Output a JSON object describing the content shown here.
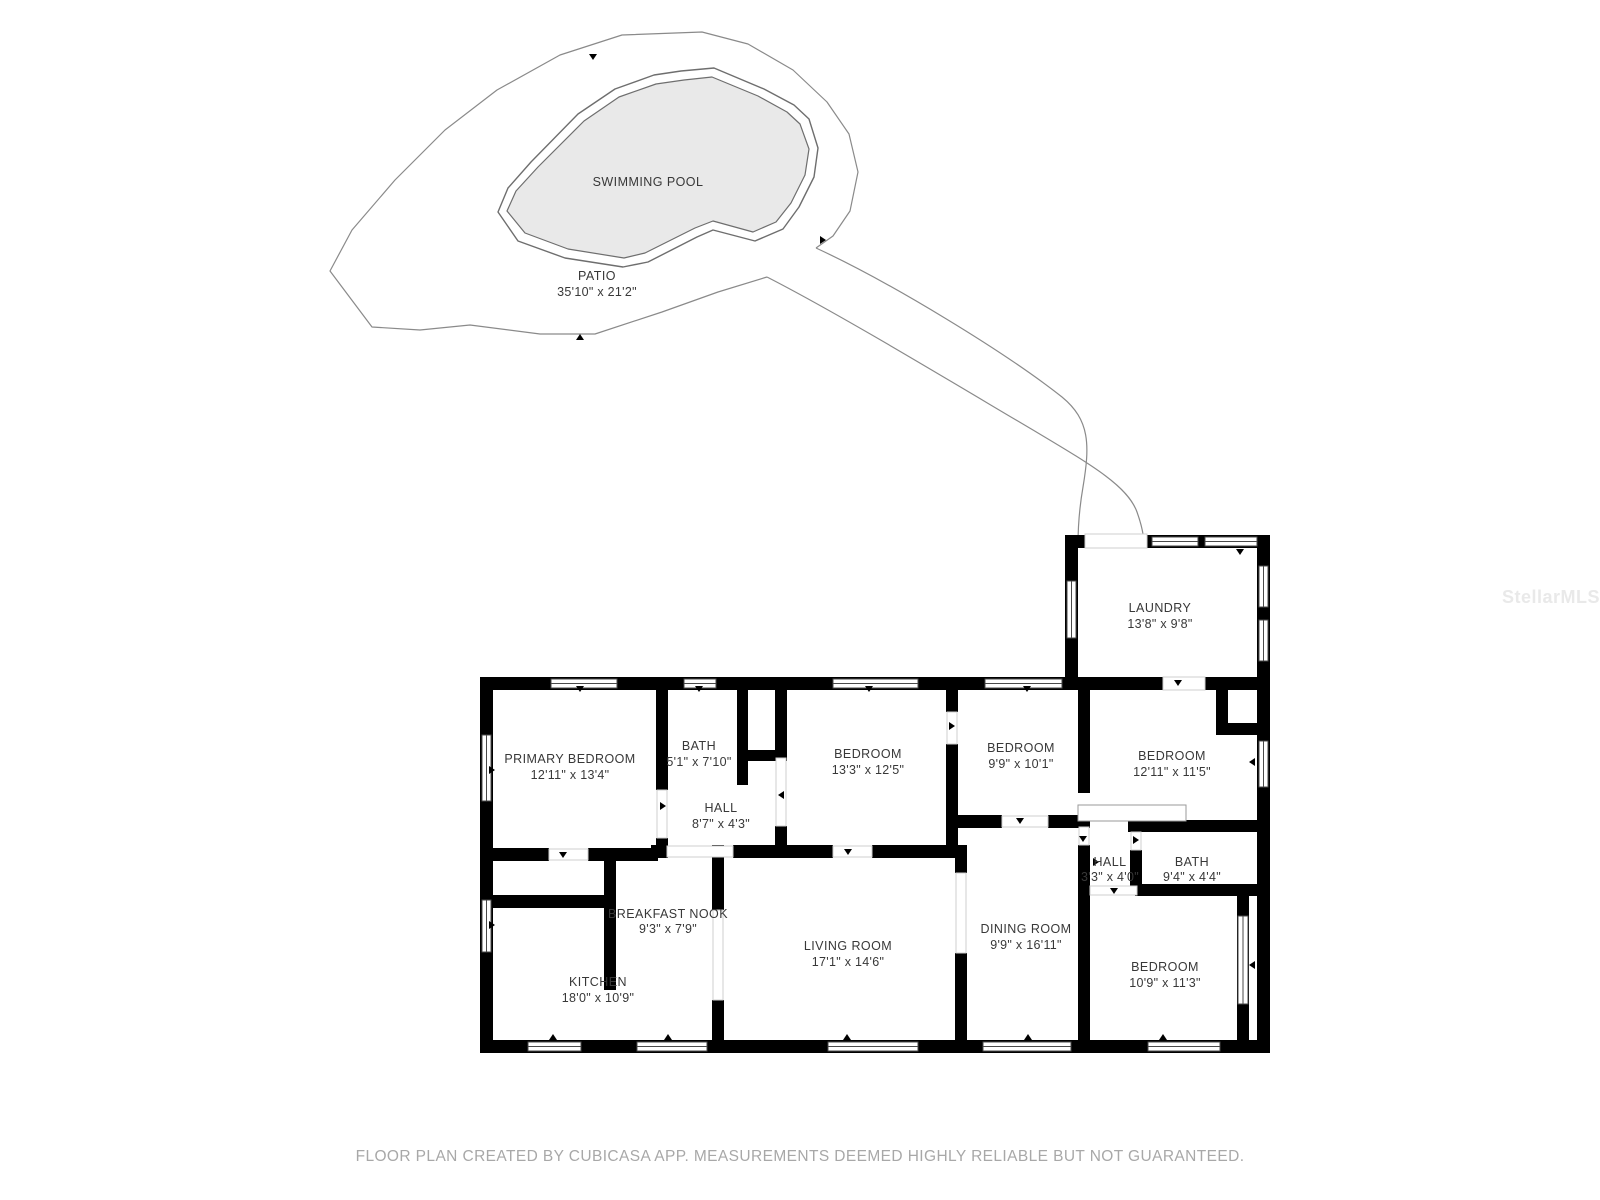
{
  "outdoor": {
    "pool_label": "SWIMMING POOL",
    "patio_label": "PATIO",
    "patio_dims": "35'10\" x 21'2\""
  },
  "rooms": [
    {
      "name": "LAUNDRY",
      "dims": "13'8\" x 9'8\""
    },
    {
      "name": "PRIMARY BEDROOM",
      "dims": "12'11\" x 13'4\""
    },
    {
      "name": "BATH",
      "dims": "5'1\" x 7'10\""
    },
    {
      "name": "HALL",
      "dims": "8'7\" x 4'3\""
    },
    {
      "name": "BEDROOM",
      "dims": "13'3\" x 12'5\""
    },
    {
      "name": "BEDROOM",
      "dims": "9'9\" x 10'1\""
    },
    {
      "name": "BEDROOM",
      "dims": "12'11\" x 11'5\""
    },
    {
      "name": "HALL",
      "dims": "3'3\" x 4'0\""
    },
    {
      "name": "BATH",
      "dims": "9'4\" x 4'4\""
    },
    {
      "name": "BEDROOM",
      "dims": "10'9\" x 11'3\""
    },
    {
      "name": "LIVING ROOM",
      "dims": "17'1\" x 14'6\""
    },
    {
      "name": "DINING ROOM",
      "dims": "9'9\" x 16'11\""
    },
    {
      "name": "KITCHEN",
      "dims": "18'0\" x 10'9\""
    },
    {
      "name": "BREAKFAST NOOK",
      "dims": "9'3\" x 7'9\""
    }
  ],
  "footer": {
    "text": "FLOOR PLAN CREATED BY CUBICASA APP. MEASUREMENTS DEEMED HIGHLY RELIABLE BUT NOT GUARANTEED."
  },
  "watermark": {
    "text": "StellarMLS"
  },
  "colors": {
    "wall": "#000000",
    "pool_fill": "#e9e9e9",
    "outdoor_outline": "#8a8a8a",
    "label": "#383838",
    "footer": "#a8a8a8",
    "watermark": "#e9e9e9"
  }
}
